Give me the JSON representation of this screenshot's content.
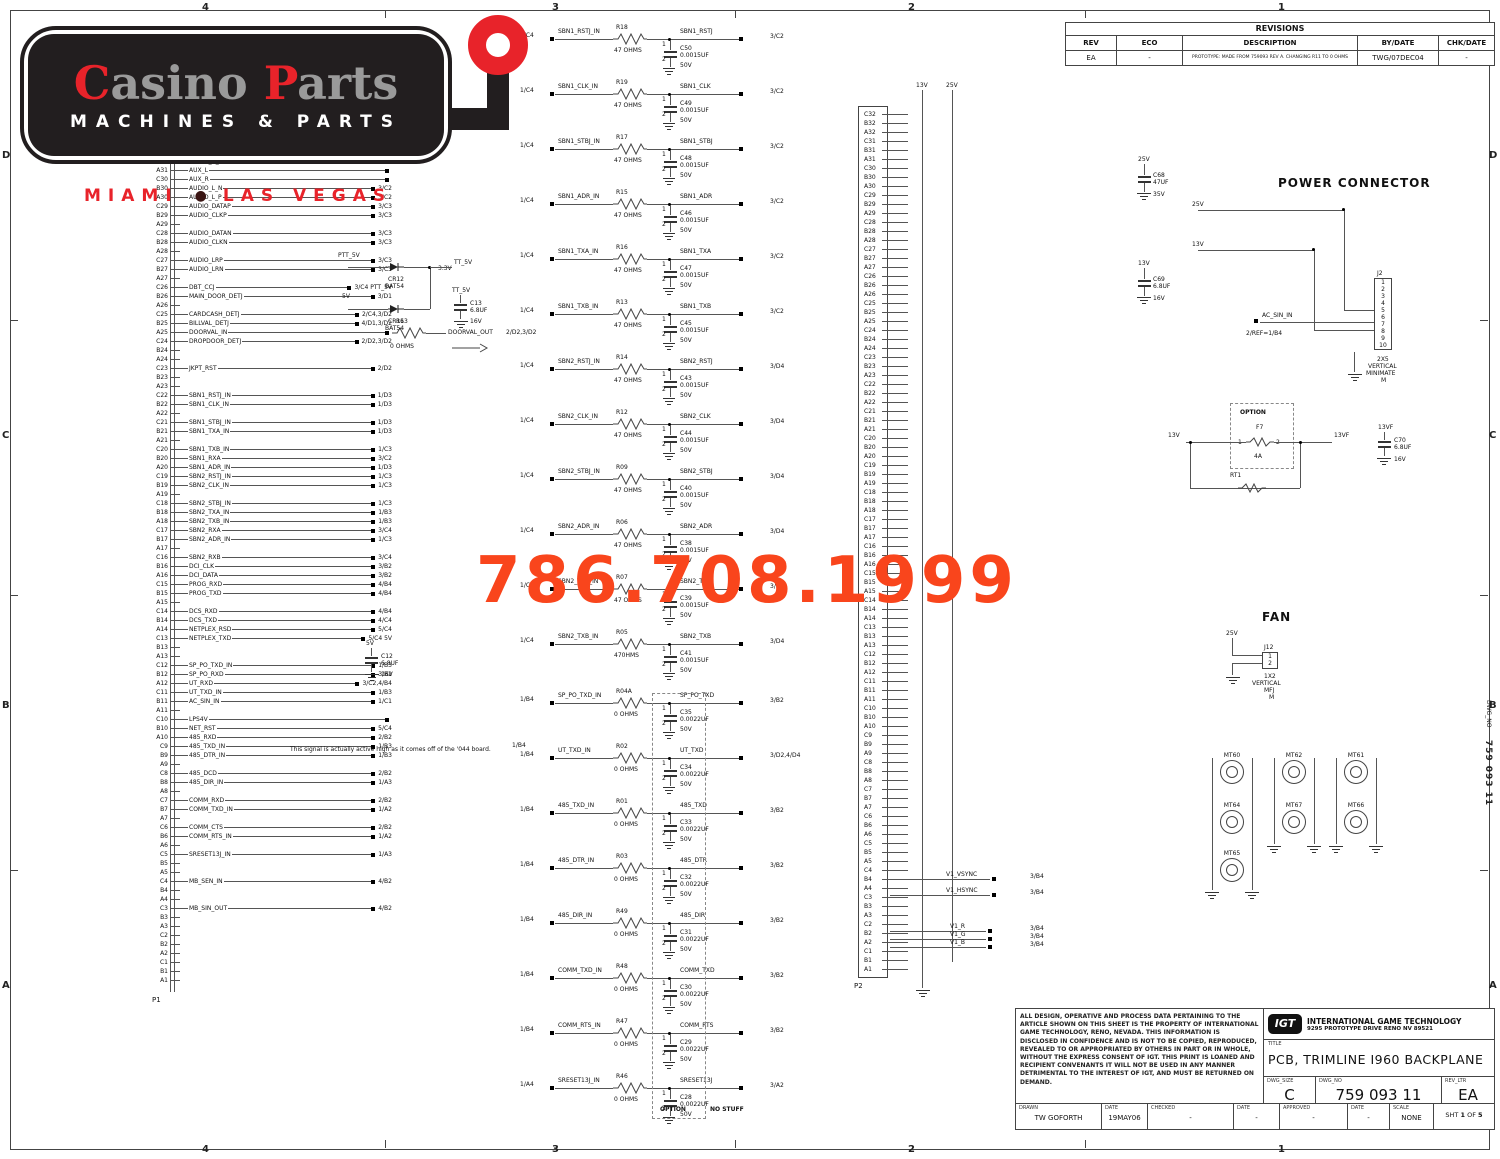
{
  "branding": {
    "name_c": "C",
    "name_rest1": "asino ",
    "name_p": "P",
    "name_rest2": "arts",
    "tagline": "MACHINES & PARTS",
    "city1": "MIAMI",
    "city2": "LAS VEGAS",
    "bullet": "●",
    "phone": "786.708.1999",
    "red": "#e8232a",
    "orange": "#f9451c"
  },
  "zones": {
    "c1": "4",
    "c2": "3",
    "c3": "2",
    "c4": "1",
    "r1": "D",
    "r2": "C",
    "r3": "B",
    "r4": "A",
    "side_zone": "B",
    "side_label": "DWG_NO",
    "side_value": "759 093 11"
  },
  "statics": {
    "one": "1",
    "two": "2"
  },
  "revisions": {
    "title": "REVISIONS",
    "h_rev": "REV",
    "h_eco": "ECO",
    "h_desc": "DESCRIPTION",
    "h_by": "BY/DATE",
    "h_chk": "CHK/DATE",
    "rev": "EA",
    "eco": "-",
    "desc": "PROTOTYPE: MADE FROM 759093 REV A. CHANGING R11 TO 0 OHMS",
    "by": "TWG/07DEC04",
    "chk": "-"
  },
  "title_block": {
    "legal": "ALL DESIGN, OPERATIVE AND PROCESS DATA PERTAINING TO THE ARTICLE SHOWN ON THIS SHEET IS THE PROPERTY OF INTERNATIONAL GAME TECHNOLOGY, RENO, NEVADA.  THIS INFORMATION IS DISCLOSED IN CONFIDENCE AND IS NOT TO BE COPIED, REPRODUCED, REVEALED TO OR APPROPRIATED BY OTHERS IN PART OR IN WHOLE, WITHOUT THE EXPRESS CONSENT OF IGT.  THIS PRINT IS LOANED AND RECIPIENT CONVENANTS IT WILL NOT BE USED IN ANY MANNER DETRIMENTAL TO THE INTEREST OF IGT, AND MUST BE RETURNED ON DEMAND.",
    "igt": "IGT",
    "company": "INTERNATIONAL GAME TECHNOLOGY",
    "address": "9295 PROTOTYPE DRIVE RENO NV 89521",
    "title_label": "TITLE",
    "title": "PCB, TRIMLINE I960 BACKPLANE",
    "dwg_size_label": "DWG_SIZE",
    "dwg_size": "C",
    "dwg_no_label": "DWG_NO",
    "dwg_no": "759 093 11",
    "rev_label": "REV_LTR",
    "rev": "EA",
    "drawn_label": "DRAWN",
    "drawn": "TW GOFORTH",
    "date1_label": "DATE",
    "date1": "19MAY06",
    "checked_label": "CHECKED",
    "checked": "-",
    "date2_label": "DATE",
    "date2": "-",
    "approved_label": "APPROVED",
    "approved": "-",
    "date3_label": "DATE",
    "date3": "-",
    "scale_label": "SCALE",
    "scale": "NONE",
    "sht": "SHT",
    "sht_no": "1",
    "of": "OF",
    "total": "5"
  },
  "left_conn": {
    "name": "P1",
    "rows": [
      {
        "p": "C31",
        "s": "AUDIO_R_P",
        "r": "3/C2"
      },
      {
        "p": "B31",
        "s": "AUDIO_R_N",
        "r": "3/C2"
      },
      {
        "p": "A31",
        "s": "AUX_L",
        "r": ""
      },
      {
        "p": "C30",
        "s": "AUX_R",
        "r": ""
      },
      {
        "p": "B30",
        "s": "AUDIO_L_N",
        "r": "3/C2"
      },
      {
        "p": "A30",
        "s": "AUDIO_L_P",
        "r": "3/C2"
      },
      {
        "p": "C29",
        "s": "AUDIO_DATAP",
        "r": "3/C3"
      },
      {
        "p": "B29",
        "s": "AUDIO_CLKP",
        "r": "3/C3"
      },
      {
        "p": "A29",
        "s": "",
        "r": ""
      },
      {
        "p": "C28",
        "s": "AUDIO_DATAN",
        "r": "3/C3"
      },
      {
        "p": "B28",
        "s": "AUDIO_CLKN",
        "r": "3/C3"
      },
      {
        "p": "A28",
        "s": "",
        "r": ""
      },
      {
        "p": "C27",
        "s": "AUDIO_LRP",
        "r": "3/C3"
      },
      {
        "p": "B27",
        "s": "AUDIO_LRN",
        "r": "3/C3"
      },
      {
        "p": "A27",
        "s": "",
        "r": ""
      },
      {
        "p": "C26",
        "s": "DBT_CCJ",
        "r": "3/C4  PTT_5V"
      },
      {
        "p": "B26",
        "s": "MAIN_DOOR_DETJ",
        "r": "3/D1"
      },
      {
        "p": "A26",
        "s": "",
        "r": ""
      },
      {
        "p": "C25",
        "s": "CARDCASH_DETJ",
        "r": "2/C4,3/D2"
      },
      {
        "p": "B25",
        "s": "BILLVAL_DETJ",
        "r": "4/D1,3/D2"
      },
      {
        "p": "A25",
        "s": "DOORVAL_IN",
        "r": ""
      },
      {
        "p": "C24",
        "s": "DROPDOOR_DETJ",
        "r": "2/D2,3/D2"
      },
      {
        "p": "B24",
        "s": "",
        "r": ""
      },
      {
        "p": "A24",
        "s": "",
        "r": ""
      },
      {
        "p": "C23",
        "s": "JKPT_RST",
        "r": "2/D2"
      },
      {
        "p": "B23",
        "s": "",
        "r": ""
      },
      {
        "p": "A23",
        "s": "",
        "r": ""
      },
      {
        "p": "C22",
        "s": "SBN1_RSTJ_IN",
        "r": "1/D3"
      },
      {
        "p": "B22",
        "s": "SBN1_CLK_IN",
        "r": "1/D3"
      },
      {
        "p": "A22",
        "s": "",
        "r": ""
      },
      {
        "p": "C21",
        "s": "SBN1_STBJ_IN",
        "r": "1/D3"
      },
      {
        "p": "B21",
        "s": "SBN1_TXA_IN",
        "r": "1/D3"
      },
      {
        "p": "A21",
        "s": "",
        "r": ""
      },
      {
        "p": "C20",
        "s": "SBN1_TXB_IN",
        "r": "1/C3"
      },
      {
        "p": "B20",
        "s": "SBN1_RXA",
        "r": "3/C2"
      },
      {
        "p": "A20",
        "s": "SBN1_ADR_IN",
        "r": "1/D3"
      },
      {
        "p": "C19",
        "s": "SBN2_RSTJ_IN",
        "r": "1/C3"
      },
      {
        "p": "B19",
        "s": "SBN2_CLK_IN",
        "r": "1/C3"
      },
      {
        "p": "A19",
        "s": "",
        "r": ""
      },
      {
        "p": "C18",
        "s": "SBN2_STBJ_IN",
        "r": "1/C3"
      },
      {
        "p": "B18",
        "s": "SBN2_TXA_IN",
        "r": "1/B3"
      },
      {
        "p": "A18",
        "s": "SBN2_TXB_IN",
        "r": "1/B3"
      },
      {
        "p": "C17",
        "s": "SBN2_RXA",
        "r": "3/C4"
      },
      {
        "p": "B17",
        "s": "SBN2_ADR_IN",
        "r": "1/C3"
      },
      {
        "p": "A17",
        "s": "",
        "r": ""
      },
      {
        "p": "C16",
        "s": "SBN2_RXB",
        "r": "3/C4"
      },
      {
        "p": "B16",
        "s": "DCI_CLK",
        "r": "3/B2"
      },
      {
        "p": "A16",
        "s": "DCI_DATA",
        "r": "3/B2"
      },
      {
        "p": "C15",
        "s": "PROG_RXD",
        "r": "4/B4"
      },
      {
        "p": "B15",
        "s": "PROG_TXD",
        "r": "4/B4"
      },
      {
        "p": "A15",
        "s": "",
        "r": ""
      },
      {
        "p": "C14",
        "s": "DCS_RXD",
        "r": "4/B4"
      },
      {
        "p": "B14",
        "s": "DCS_TXD",
        "r": "4/C4"
      },
      {
        "p": "A14",
        "s": "NETPLEX_RSD",
        "r": "5/C4"
      },
      {
        "p": "C13",
        "s": "NETPLEX_TXD",
        "r": "5/C4  5V"
      },
      {
        "p": "B13",
        "s": "",
        "r": ""
      },
      {
        "p": "A13",
        "s": "",
        "r": ""
      },
      {
        "p": "C12",
        "s": "SP_PO_TXD_IN",
        "r": "1/B3"
      },
      {
        "p": "B12",
        "s": "SP_PO_RXD",
        "r": "3/B2"
      },
      {
        "p": "A12",
        "s": "UT_RXD",
        "r": "3/C2,4/B4"
      },
      {
        "p": "C11",
        "s": "UT_TXD_IN",
        "r": "1/B3"
      },
      {
        "p": "B11",
        "s": "AC_SIN_IN",
        "r": "1/C1"
      },
      {
        "p": "A11",
        "s": "",
        "r": ""
      },
      {
        "p": "C10",
        "s": "LPS4V",
        "r": ""
      },
      {
        "p": "B10",
        "s": "NET_RST",
        "r": "5/C4"
      },
      {
        "p": "A10",
        "s": "485_RXD",
        "r": "2/B2"
      },
      {
        "p": "C9",
        "s": "485_TXD_IN",
        "r": "1/B3"
      },
      {
        "p": "B9",
        "s": "485_DTR_IN",
        "r": "1/B3"
      },
      {
        "p": "A9",
        "s": "",
        "r": ""
      },
      {
        "p": "C8",
        "s": "485_DCD",
        "r": "2/B2"
      },
      {
        "p": "B8",
        "s": "485_DIR_IN",
        "r": "1/A3"
      },
      {
        "p": "A8",
        "s": "",
        "r": ""
      },
      {
        "p": "C7",
        "s": "COMM_RXD",
        "r": "2/B2"
      },
      {
        "p": "B7",
        "s": "COMM_TXD_IN",
        "r": "1/A2"
      },
      {
        "p": "A7",
        "s": "",
        "r": ""
      },
      {
        "p": "C6",
        "s": "COMM_CTS",
        "r": "2/B2"
      },
      {
        "p": "B6",
        "s": "COMM_RTS_IN",
        "r": "1/A2"
      },
      {
        "p": "A6",
        "s": "",
        "r": ""
      },
      {
        "p": "C5",
        "s": "SRESET13J_IN",
        "r": "1/A3"
      },
      {
        "p": "B5",
        "s": "",
        "r": ""
      },
      {
        "p": "A5",
        "s": "",
        "r": ""
      },
      {
        "p": "C4",
        "s": "MB_SEN_IN",
        "r": "4/B2"
      },
      {
        "p": "B4",
        "s": "",
        "r": ""
      },
      {
        "p": "A4",
        "s": "",
        "r": ""
      },
      {
        "p": "C3",
        "s": "MB_SIN_OUT",
        "r": "4/B2"
      },
      {
        "p": "B3",
        "s": "",
        "r": ""
      },
      {
        "p": "A3",
        "s": "",
        "r": ""
      },
      {
        "p": "C2",
        "s": "",
        "r": ""
      },
      {
        "p": "B2",
        "s": "",
        "r": ""
      },
      {
        "p": "A2",
        "s": "",
        "r": ""
      },
      {
        "p": "C1",
        "s": "",
        "r": ""
      },
      {
        "p": "B1",
        "s": "",
        "r": ""
      },
      {
        "p": "A1",
        "s": "",
        "r": ""
      }
    ]
  },
  "rc": {
    "option": "OPTION",
    "no_stuff": "NO STUFF",
    "g1": [
      {
        "lr": "1/C4",
        "in": "SBN1_RSTJ_IN",
        "rr": "R18",
        "rv": "47 OHMS",
        "cr": "C50",
        "cv": "0.0015UF",
        "volt": "50V",
        "out": "SBN1_RSTJ",
        "or": "3/C2"
      },
      {
        "lr": "1/C4",
        "in": "SBN1_CLK_IN",
        "rr": "R19",
        "rv": "47 OHMS",
        "cr": "C49",
        "cv": "0.0015UF",
        "volt": "50V",
        "out": "SBN1_CLK",
        "or": "3/C2"
      },
      {
        "lr": "1/C4",
        "in": "SBN1_STBJ_IN",
        "rr": "R17",
        "rv": "47 OHMS",
        "cr": "C48",
        "cv": "0.0015UF",
        "volt": "50V",
        "out": "SBN1_STBJ",
        "or": "3/C2"
      },
      {
        "lr": "1/C4",
        "in": "SBN1_ADR_IN",
        "rr": "R15",
        "rv": "47 OHMS",
        "cr": "C46",
        "cv": "0.0015UF",
        "volt": "50V",
        "out": "SBN1_ADR",
        "or": "3/C2"
      },
      {
        "lr": "1/C4",
        "in": "SBN1_TXA_IN",
        "rr": "R16",
        "rv": "47 OHMS",
        "cr": "C47",
        "cv": "0.0015UF",
        "volt": "50V",
        "out": "SBN1_TXA",
        "or": "3/C2"
      },
      {
        "lr": "1/C4",
        "in": "SBN1_TXB_IN",
        "rr": "R13",
        "rv": "47 OHMS",
        "cr": "C45",
        "cv": "0.0015UF",
        "volt": "50V",
        "out": "SBN1_TXB",
        "or": "3/C2"
      },
      {
        "lr": "1/C4",
        "in": "SBN2_RSTJ_IN",
        "rr": "R14",
        "rv": "47 OHMS",
        "cr": "C43",
        "cv": "0.0015UF",
        "volt": "50V",
        "out": "SBN2_RSTJ",
        "or": "3/D4"
      },
      {
        "lr": "1/C4",
        "in": "SBN2_CLK_IN",
        "rr": "R12",
        "rv": "47 OHMS",
        "cr": "C44",
        "cv": "0.0015UF",
        "volt": "50V",
        "out": "SBN2_CLK",
        "or": "3/D4"
      },
      {
        "lr": "1/C4",
        "in": "SBN2_STBJ_IN",
        "rr": "R09",
        "rv": "47 OHMS",
        "cr": "C40",
        "cv": "0.0015UF",
        "volt": "50V",
        "out": "SBN2_STBJ",
        "or": "3/D4"
      },
      {
        "lr": "1/C4",
        "in": "SBN2_ADR_IN",
        "rr": "R06",
        "rv": "47 OHMS",
        "cr": "C38",
        "cv": "0.0015UF",
        "volt": "50V",
        "out": "SBN2_ADR",
        "or": "3/D4"
      },
      {
        "lr": "1/C4",
        "in": "SBN2_TXA_IN",
        "rr": "R07",
        "rv": "47 OHMS",
        "cr": "C39",
        "cv": "0.0015UF",
        "volt": "50V",
        "out": "SBN2_TXA",
        "or": "3/D4"
      },
      {
        "lr": "1/C4",
        "in": "SBN2_TXB_IN",
        "rr": "R05",
        "rv": "470HMS",
        "cr": "C41",
        "cv": "0.0015UF",
        "volt": "50V",
        "out": "SBN2_TXB",
        "or": "3/D4"
      }
    ],
    "g2": [
      {
        "lr": "1/B4",
        "in": "SP_PO_TXD_IN",
        "rr": "R04A",
        "rv": "0 OHMS",
        "cr": "C35",
        "cv": "0.0022UF",
        "volt": "50V",
        "out": "SP_PO_TXD",
        "or": "3/B2"
      },
      {
        "lr": "1/B4",
        "in": "UT_TXD_IN",
        "rr": "R02",
        "rv": "0 OHMS",
        "cr": "C34",
        "cv": "0.0022UF",
        "volt": "50V",
        "out": "UT_TXD",
        "or": "3/D2,4/D4"
      },
      {
        "lr": "1/B4",
        "in": "485_TXD_IN",
        "rr": "R01",
        "rv": "0 OHMS",
        "cr": "C33",
        "cv": "0.0022UF",
        "volt": "50V",
        "out": "485_TXD",
        "or": "3/B2"
      },
      {
        "lr": "1/B4",
        "in": "485_DTR_IN",
        "rr": "R03",
        "rv": "0 OHMS",
        "cr": "C32",
        "cv": "0.0022UF",
        "volt": "50V",
        "out": "485_DTR",
        "or": "3/B2"
      },
      {
        "lr": "1/B4",
        "in": "485_DIR_IN",
        "rr": "R49",
        "rv": "0 OHMS",
        "cr": "C31",
        "cv": "0.0022UF",
        "volt": "50V",
        "out": "485_DIR",
        "or": "3/B2"
      },
      {
        "lr": "1/B4",
        "in": "COMM_TXD_IN",
        "rr": "R48",
        "rv": "0 OHMS",
        "cr": "C30",
        "cv": "0.0022UF",
        "volt": "50V",
        "out": "COMM_TXD",
        "or": "3/B2"
      },
      {
        "lr": "1/B4",
        "in": "COMM_RTS_IN",
        "rr": "R47",
        "rv": "0 OHMS",
        "cr": "C29",
        "cv": "0.0022UF",
        "volt": "50V",
        "out": "COMM_RTS",
        "or": "3/B2"
      },
      {
        "lr": "1/A4",
        "in": "SRESET13J_IN",
        "rr": "R46",
        "rv": "0 OHMS",
        "cr": "C28",
        "cv": "0.0022UF",
        "volt": "50V",
        "out": "SRESET13J",
        "or": "3/A2"
      }
    ]
  },
  "p2": {
    "name": "P2",
    "rail1": "13V",
    "rail2": "25V",
    "pins": [
      "C32",
      "B32",
      "A32",
      "C31",
      "B31",
      "A31",
      "C30",
      "B30",
      "A30",
      "C29",
      "B29",
      "A29",
      "C28",
      "B28",
      "A28",
      "C27",
      "B27",
      "A27",
      "C26",
      "B26",
      "A26",
      "C25",
      "B25",
      "A25",
      "C24",
      "B24",
      "A24",
      "C23",
      "B23",
      "A23",
      "C22",
      "B22",
      "A22",
      "C21",
      "B21",
      "A21",
      "C20",
      "B20",
      "A20",
      "C19",
      "B19",
      "A19",
      "C18",
      "B18",
      "A18",
      "C17",
      "B17",
      "A17",
      "C16",
      "B16",
      "A16",
      "C15",
      "B15",
      "A15",
      "C14",
      "B14",
      "A14",
      "C13",
      "B13",
      "A13",
      "C12",
      "B12",
      "A12",
      "C11",
      "B11",
      "A11",
      "C10",
      "B10",
      "A10",
      "C9",
      "B9",
      "A9",
      "C8",
      "B8",
      "A8",
      "C7",
      "B7",
      "A7",
      "C6",
      "B6",
      "A6",
      "C5",
      "B5",
      "A5",
      "C4",
      "B4",
      "A4",
      "C3",
      "B3",
      "A3",
      "C2",
      "B2",
      "A2",
      "C1",
      "B1",
      "A1"
    ],
    "vid1": {
      "s": "V1_VSYNC",
      "r": "3/B4"
    },
    "vid2": {
      "s": "V1_HSYNC",
      "r": "3/B4"
    },
    "vid3": {
      "s": "V1_R",
      "r": "3/B4"
    },
    "vid4": {
      "s": "V1_G",
      "r": "3/B4"
    },
    "vid5": {
      "s": "V1_B",
      "r": "3/B4"
    }
  },
  "power": {
    "title": "POWER CONNECTOR",
    "rail25": "25V",
    "rail13": "13V",
    "c68": {
      "top": "25V",
      "ref": "C68",
      "val": "47UF",
      "volt": "35V"
    },
    "c69": {
      "top": "13V",
      "ref": "C69",
      "val": "6.8UF",
      "volt": "16V"
    },
    "j2": {
      "name": "J2",
      "pins": [
        "1",
        "2",
        "3",
        "4",
        "5",
        "6",
        "7",
        "8",
        "9",
        "10"
      ],
      "l1": "2X5",
      "l2": "VERTICAL",
      "l3": "MINIMATE",
      "l4": "M"
    },
    "ac": "AC_SIN_IN",
    "acref": "2/REF=1/B4"
  },
  "option_fuse": {
    "box": "OPTION",
    "f": "F7",
    "a": "4A",
    "in": "13V",
    "out": "13VF",
    "rt": "RT1",
    "c70": {
      "top": "13VF",
      "ref": "C70",
      "val": "6.8UF",
      "volt": "16V"
    }
  },
  "fan": {
    "title": "FAN",
    "rail": "25V",
    "j12": {
      "name": "J12",
      "p1": "1",
      "p2": "2",
      "l1": "1X2",
      "l2": "VERTICAL",
      "l3": "MFJ",
      "l4": "M"
    },
    "mounts": [
      "MT60",
      "MT62",
      "MT61",
      "MT64",
      "MT67",
      "MT66",
      "MT65"
    ]
  },
  "diodes": {
    "in1": "PTT_5V",
    "in2": "5V",
    "d1": "CR12",
    "d1t": "BAT54",
    "d2": "CR11",
    "d2t": "BAT54",
    "out": "TT_5V",
    "c13": {
      "top": "TT_5V",
      "ref": "C13",
      "val": "6.8UF",
      "volt": "16V"
    }
  },
  "c12": {
    "top": "5V",
    "ref": "C12",
    "val": "6.8UF",
    "volt": "16V"
  },
  "doorval": {
    "r": "R63",
    "val": "0 OHMS",
    "out": "DOORVAL_OUT",
    "ref": "2/D2,3/D2"
  },
  "note": {
    "text": "This signal is actually active high as it comes off of the '044 board.",
    "ref": "1/B4"
  },
  "labels": {
    "v33": "3.3V"
  }
}
